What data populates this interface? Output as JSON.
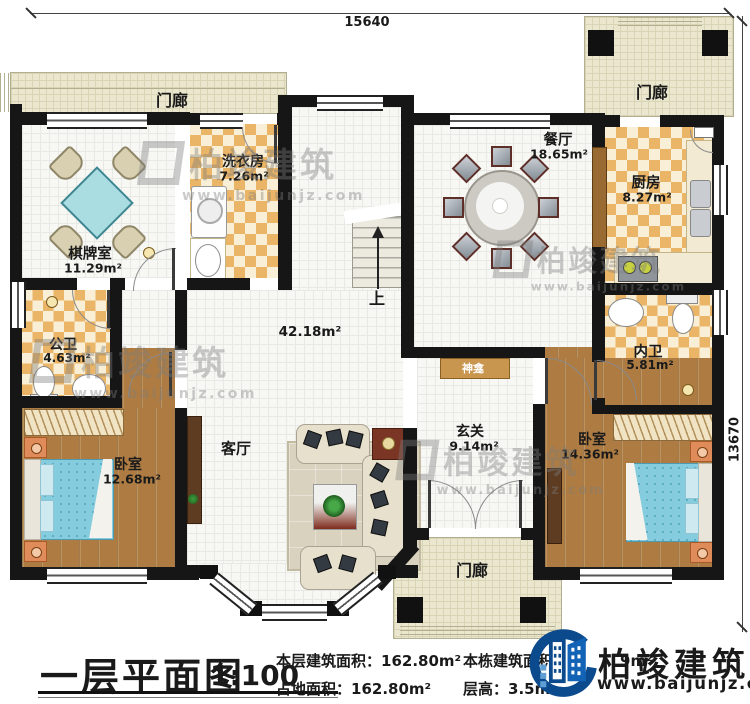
{
  "plan": {
    "dimensions": {
      "width_mm": "15640",
      "height_mm": "13670"
    },
    "rooms": {
      "porch_top_left": {
        "name": "门廊"
      },
      "porch_top_right": {
        "name": "门廊"
      },
      "porch_bottom": {
        "name": "门廊"
      },
      "chess_room": {
        "name": "棋牌室",
        "area": "11.29m²"
      },
      "laundry_room": {
        "name": "洗衣房",
        "area": "7.26m²"
      },
      "dining_room": {
        "name": "餐厅",
        "area": "18.65m²"
      },
      "kitchen": {
        "name": "厨房",
        "area": "8.27m²"
      },
      "public_bathroom": {
        "name": "公卫",
        "area": "4.63m²"
      },
      "private_bathroom": {
        "name": "内卫",
        "area": "5.81m²"
      },
      "bedroom_left": {
        "name": "卧室",
        "area": "12.68m²"
      },
      "bedroom_right": {
        "name": "卧室",
        "area": "14.36m²"
      },
      "living_room": {
        "name": "客厅",
        "area": "42.18m²"
      },
      "foyer": {
        "name": "玄关",
        "area": "9.14m²"
      },
      "shrine": {
        "name": "神龛"
      },
      "stairs": {
        "direction_label": "上"
      }
    }
  },
  "title_block": {
    "title": "一层平面图",
    "scale": "1:100",
    "floor_area_label": "本层建筑面积：",
    "floor_area_value": "162.80m²",
    "footprint_label": "占地面积：",
    "footprint_value": "162.80m²",
    "building_total_label": "本栋建筑面积：",
    "building_total_value_visible": "9",
    "storey_height_label": "层高：",
    "storey_height_value": "3.5m"
  },
  "branding": {
    "logo_text": "柏竣建筑",
    "logo_url": "www.baijunjz.com",
    "watermark_text": "柏竣建筑",
    "watermark_url": "www.baijunjz.com"
  }
}
